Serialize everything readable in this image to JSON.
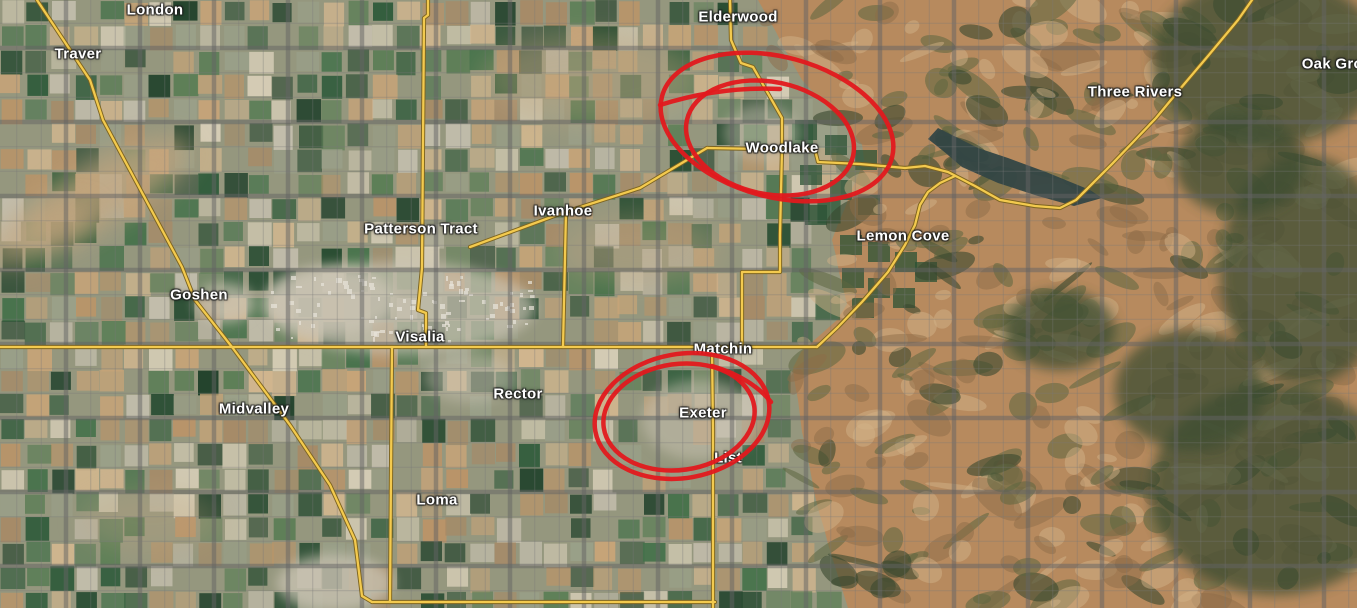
{
  "map": {
    "view": "satellite",
    "description": "Satellite map of Tulare County area with hand-drawn red circles around Woodlake and Exeter",
    "labels": [
      {
        "id": "london",
        "text": "London",
        "x": 155,
        "y": 10
      },
      {
        "id": "traver",
        "text": "Traver",
        "x": 78,
        "y": 54
      },
      {
        "id": "elderwood",
        "text": "Elderwood",
        "x": 738,
        "y": 17
      },
      {
        "id": "oak-grove",
        "text": "Oak Grove",
        "x": 1341,
        "y": 64
      },
      {
        "id": "three-rivers",
        "text": "Three Rivers",
        "x": 1135,
        "y": 92
      },
      {
        "id": "woodlake",
        "text": "Woodlake",
        "x": 782,
        "y": 148
      },
      {
        "id": "ivanhoe",
        "text": "Ivanhoe",
        "x": 563,
        "y": 211
      },
      {
        "id": "patterson-tract",
        "text": "Patterson Tract",
        "x": 421,
        "y": 229
      },
      {
        "id": "lemon-cove",
        "text": "Lemon Cove",
        "x": 903,
        "y": 236
      },
      {
        "id": "goshen",
        "text": "Goshen",
        "x": 199,
        "y": 295
      },
      {
        "id": "visalia",
        "text": "Visalia",
        "x": 420,
        "y": 337
      },
      {
        "id": "matchin",
        "text": "Matchin",
        "x": 723,
        "y": 349
      },
      {
        "id": "rector",
        "text": "Rector",
        "x": 518,
        "y": 394
      },
      {
        "id": "midvalley",
        "text": "Midvalley",
        "x": 254,
        "y": 409
      },
      {
        "id": "exeter",
        "text": "Exeter",
        "x": 703,
        "y": 413
      },
      {
        "id": "list",
        "text": "List",
        "x": 728,
        "y": 458
      },
      {
        "id": "loma",
        "text": "Loma",
        "x": 437,
        "y": 500
      }
    ],
    "annotations": [
      {
        "id": "woodlake-circle",
        "target": "Woodlake",
        "shape": "double-ellipse"
      },
      {
        "id": "exeter-circle",
        "target": "Exeter",
        "shape": "double-ellipse"
      }
    ],
    "colors": {
      "annotation": "#e2191d",
      "label": "#ffffff",
      "road_fill": "#f3ca4e",
      "road_casing": "#7d6420",
      "grid_major": "#646464",
      "grid_minor": "#787878",
      "water": "#334644",
      "valley_base": "#95977e",
      "mountain_base": "#b78a5e",
      "forest": "#3c4e33",
      "urban": "#cbc4b4"
    }
  }
}
